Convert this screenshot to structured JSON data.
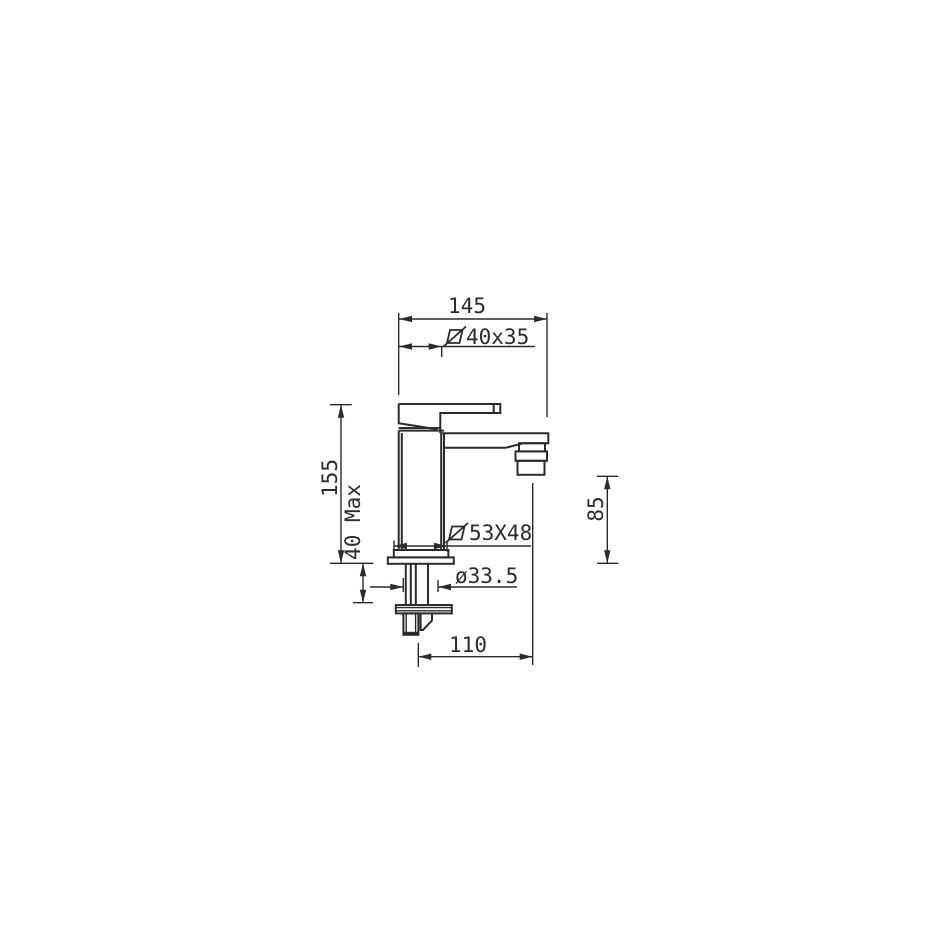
{
  "page": {
    "background": "#ffffff",
    "line_color": "#2b2b2b",
    "text_color": "#2b2b2b"
  },
  "drawing": {
    "kind": "technical-dimension-drawing",
    "view": "side-elevation-of-single-lever-mixer-tap"
  },
  "symbols": {
    "handle_section_symbol": "square-slash",
    "base_section_symbol": "square-slash"
  },
  "dimensions": {
    "overall_width": {
      "label": "145"
    },
    "handle_section": {
      "label": "40x35"
    },
    "body_height": {
      "label": "155"
    },
    "deck_thickness": {
      "label": "40 Max"
    },
    "base_section": {
      "label": "53X48"
    },
    "hole_diameter": {
      "label": "ø33.5"
    },
    "outlet_height": {
      "label": "85"
    },
    "spout_reach": {
      "label": "110"
    }
  }
}
